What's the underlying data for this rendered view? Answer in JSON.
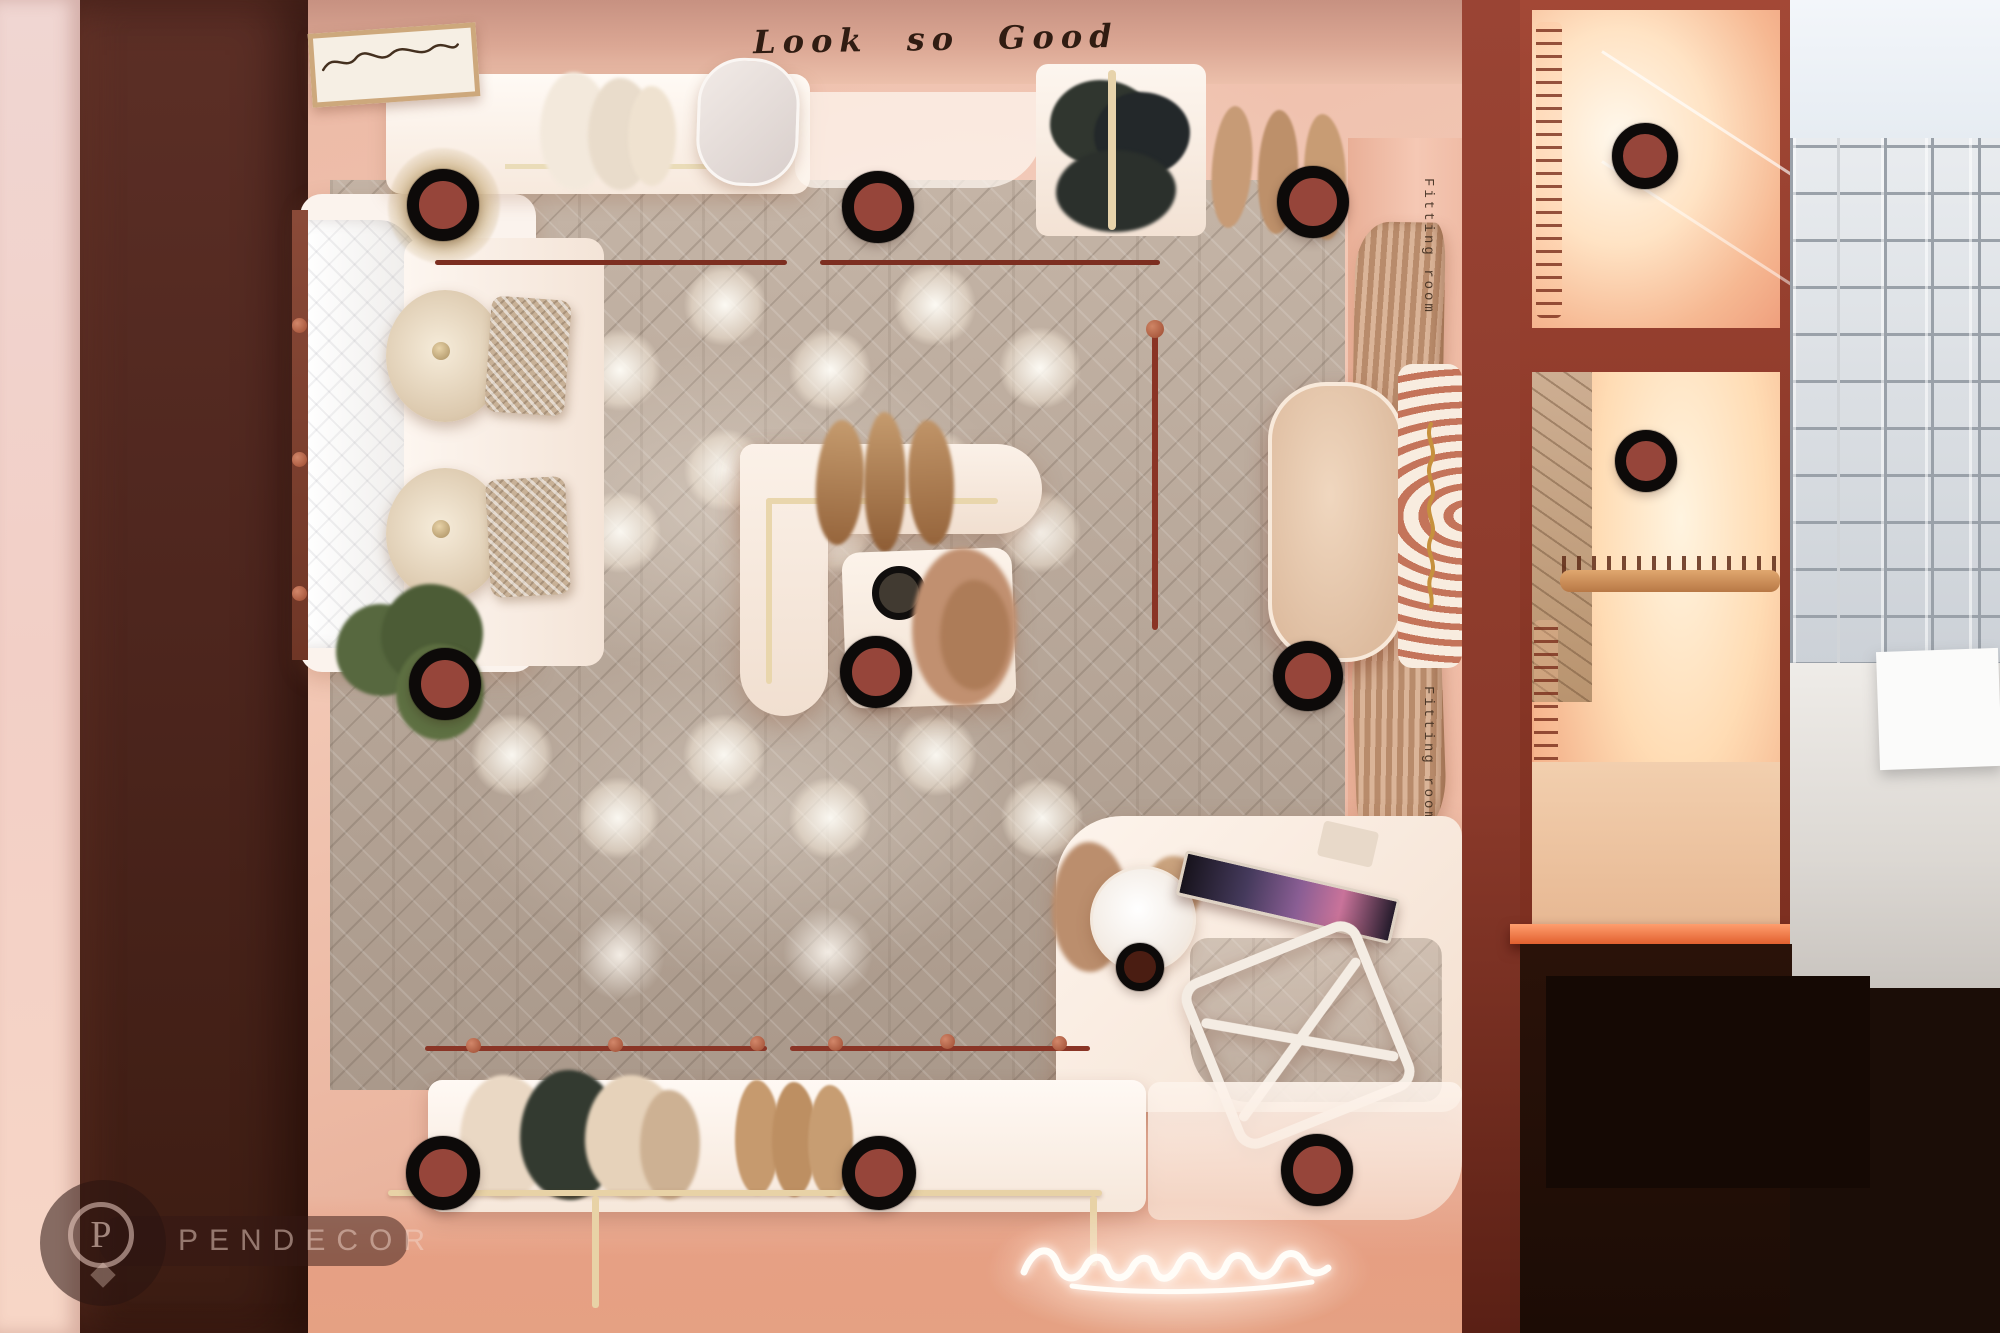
{
  "scene": {
    "wall_sign_text": "Look so Good",
    "fitting_room_labels": [
      "Fitting room",
      "Fitting room"
    ],
    "neon_sign_icon": "glowing-script-sign-icon",
    "niche_decal_icon": "gold-brand-script-icon",
    "framed_art_icon": "script-art-print-icon"
  },
  "watermark": {
    "brand": "PENDECOR",
    "icon": "pendecor-p-badge-icon",
    "monogram": "P"
  },
  "hotspots": {
    "icon": "panorama-hotspot-icon",
    "style": {
      "ring_color": "#0d0a09",
      "fill_color": "#96453a"
    },
    "points": [
      {
        "name": "window-display",
        "x": 443,
        "y": 205,
        "d": 72
      },
      {
        "name": "entry-center",
        "x": 878,
        "y": 207,
        "d": 72
      },
      {
        "name": "shoe-display",
        "x": 1313,
        "y": 202,
        "d": 72
      },
      {
        "name": "closet-top",
        "x": 1645,
        "y": 156,
        "d": 66
      },
      {
        "name": "closet-middle",
        "x": 1646,
        "y": 461,
        "d": 62
      },
      {
        "name": "lounge-plant",
        "x": 445,
        "y": 684,
        "d": 72
      },
      {
        "name": "center-display",
        "x": 876,
        "y": 672,
        "d": 72
      },
      {
        "name": "fitting-bench",
        "x": 1308,
        "y": 676,
        "d": 70
      },
      {
        "name": "cash-desk",
        "x": 1140,
        "y": 967,
        "d": 48,
        "fill": "#4a1d12"
      },
      {
        "name": "rack-left",
        "x": 443,
        "y": 1173,
        "d": 74
      },
      {
        "name": "rack-center",
        "x": 879,
        "y": 1173,
        "d": 74
      },
      {
        "name": "rack-right",
        "x": 1317,
        "y": 1170,
        "d": 72
      }
    ]
  },
  "colors": {
    "wall_pink": "#eec0ac",
    "wall_maroon": "#8c3a2a",
    "dark_wood_wall": "#4e261e",
    "floor_wood": "#b5a497",
    "platform_white": "#fdf6f0",
    "brass_rail": "#e8d2a6",
    "maroon_rail": "#8a3526",
    "hotspot_ring": "#0d0a09",
    "hotspot_fill": "#96453a",
    "neon_glow": "#fffdf8",
    "tile_wall": "#e4e7eb"
  }
}
